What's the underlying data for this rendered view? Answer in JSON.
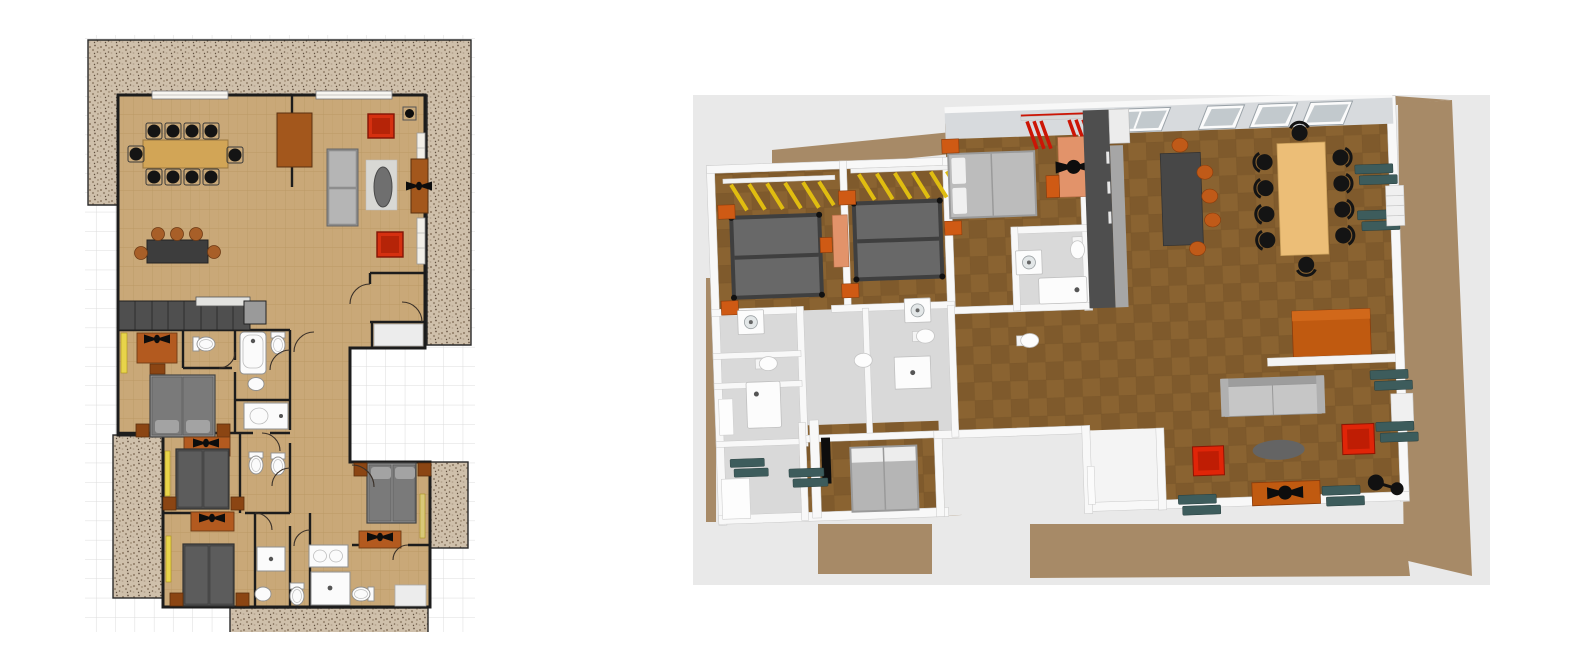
{
  "app": {
    "description_left_panel": "2D floor plan",
    "description_right_panel": "3D overhead view"
  },
  "colors": {
    "canvas": "#ffffff",
    "grid_line": "#dcdcdc",
    "terrace_base": "#cfc0ab",
    "wall_2d": "#1c1c1c",
    "floor_2d": "#c9a878",
    "floor_2d_line": "#b5945e",
    "table_tan": "#d2a556",
    "chair_black": "#141414",
    "table_dark": "#3d3d3d",
    "chair_brown": "#a85f28",
    "cabinet_brown": "#a3571c",
    "sofa_gray": "#8f8f8f",
    "cushion_gray": "#b5b5b5",
    "red_chair": "#d53010",
    "oval_gray": "#6f6f6f",
    "kitchen_dark": "#4f4f4f",
    "appliance_gray": "#9a9a9a",
    "bed_gray": "#7a7a7a",
    "bed_dark": "#5c5c5c",
    "nightstand_brown": "#8b4513",
    "desk_brown": "#b35a1f",
    "wardrobe_yellow": "#e8d44a",
    "fixture_white": "#fbfbfb",
    "fixture_line": "#8f8f8f",
    "bg_3d": "#e9e9e9",
    "deck_3d": "#a78a67",
    "wall_3d": "#f8f8f8",
    "wall_3d_shade": "#d7dadd",
    "floor_3d": "#8a6331",
    "floor_3d_alt": "#7f5a2c",
    "bath_floor_3d": "#d9d9d9",
    "bed3d_frame": "#3f3f3f",
    "bed3d_dark": "#686868",
    "bed3d_light": "#bcbcbc",
    "nightstand_orange": "#cf5a14",
    "desk_salmon": "#e2936a",
    "clothes_yellow": "#e0bd10",
    "clothes_red": "#cc1505",
    "dining3d_tan": "#ecbe77",
    "kitchen3d_dark": "#4e4e4e",
    "shutter_teal": "#3d5c5c",
    "sideboard_orange": "#c05a10",
    "sofa3d_gray": "#c6c6c6",
    "red3d": "#e02508"
  },
  "inventory": {
    "plan2d": [
      "terrace",
      "dining-table-10-chairs",
      "breakfast-table-5-chairs",
      "sideboard",
      "sofa",
      "red-armchairs",
      "oval-coffee-table",
      "tv-cabinet-with-fan",
      "kitchen-counter",
      "double-bed",
      "twin-beds",
      "desks-with-fans",
      "wardrobes",
      "toilets",
      "bathtubs",
      "showers",
      "sinks",
      "door-swings",
      "windows"
    ],
    "view3d": [
      "wood-deck",
      "twin-bedrooms-with-yellow-clothes",
      "master-bedroom-with-red-clothes",
      "gray-beds",
      "orange-nightstands",
      "salmon-desks-with-fans",
      "bathrooms",
      "washing-machines",
      "toilets",
      "bathtubs",
      "kitchen-counter",
      "dining-table-10-black-chairs",
      "breakfast-table-orange-chairs",
      "orange-sideboard",
      "gray-sofa",
      "red-armchairs",
      "oval-coffee-table",
      "tv-cabinet",
      "teal-shutters",
      "skylights",
      "floor-lamp"
    ]
  }
}
